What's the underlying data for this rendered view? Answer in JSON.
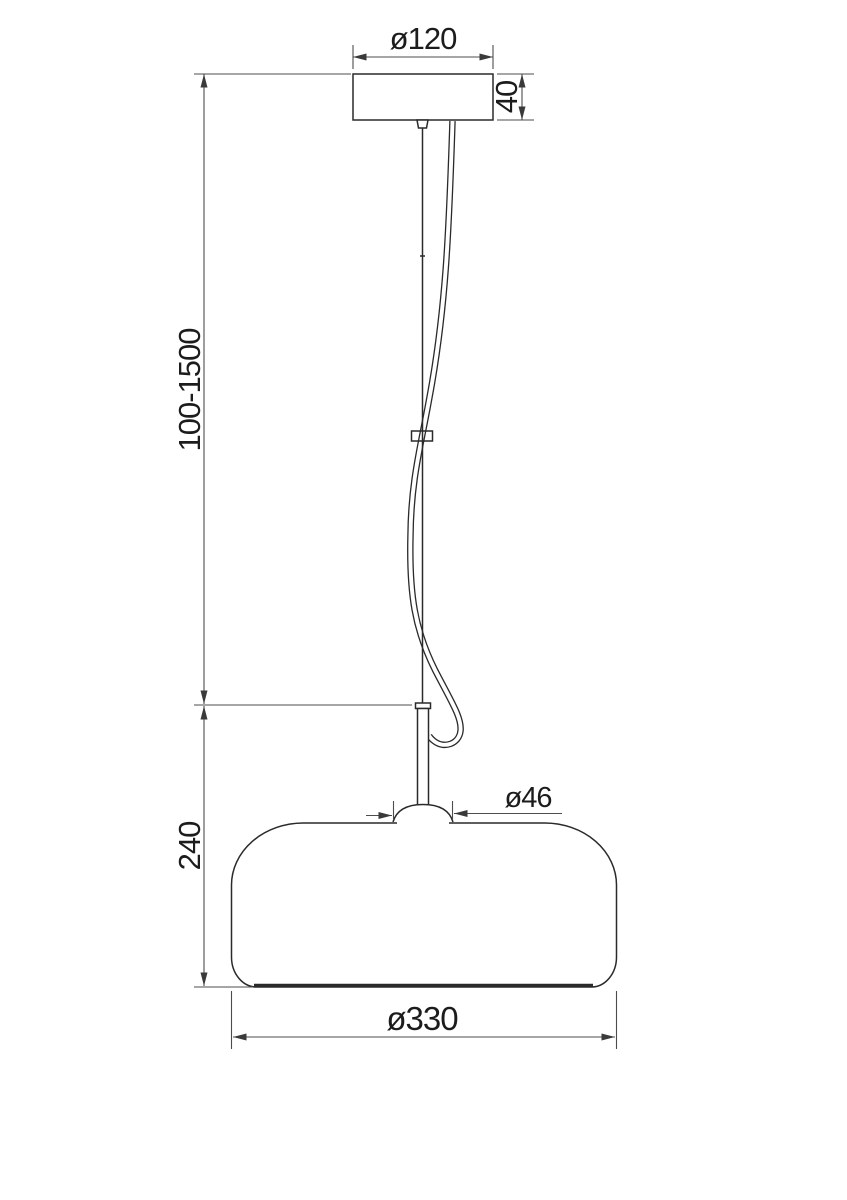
{
  "drawing": {
    "subject": "pendant-lamp-dimension-drawing",
    "labels": {
      "canopy_diameter": "ø120",
      "canopy_height": "40",
      "suspension_range": "100-1500",
      "fixture_height": "240",
      "neck_diameter": "ø46",
      "shade_diameter": "ø330"
    },
    "colors": {
      "background": "#ffffff",
      "object_line": "#2a2a2a",
      "dimension_line": "#4d4d4d",
      "text": "#1c1c1c"
    }
  }
}
